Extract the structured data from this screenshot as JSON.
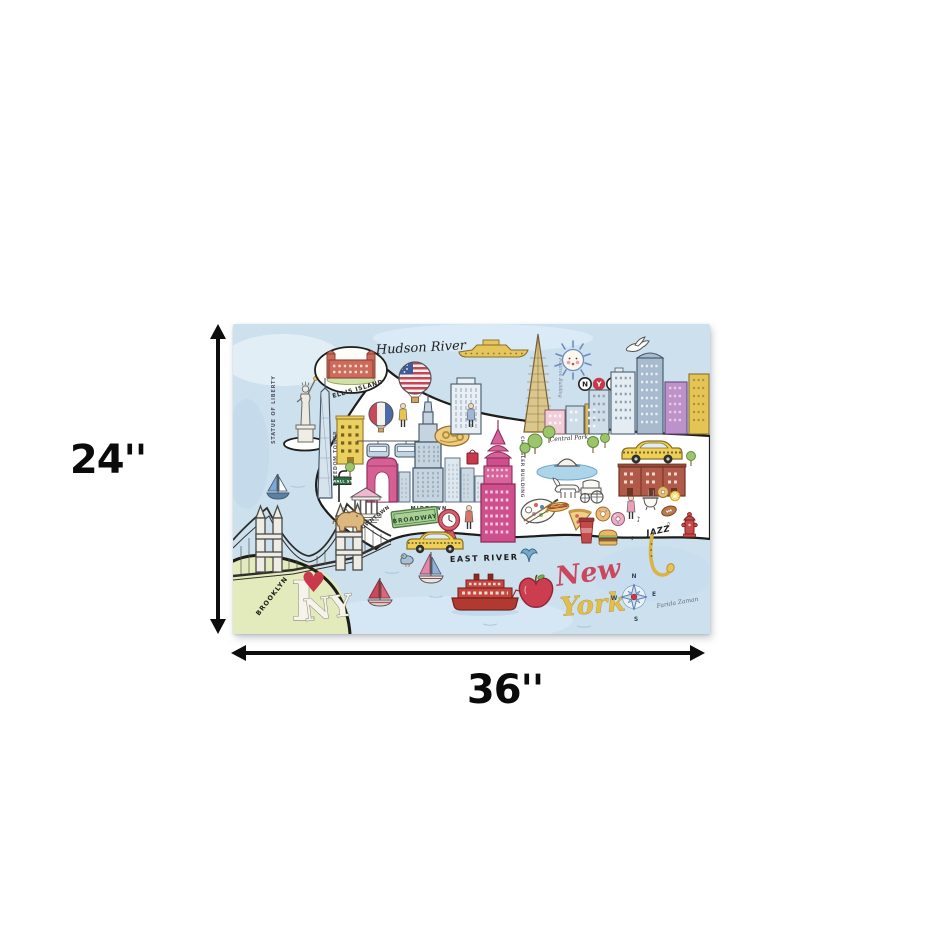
{
  "dimension_annotations": {
    "height_label": "24''",
    "width_label": "36''"
  },
  "artwork": {
    "rivers": {
      "hudson": "Hudson River",
      "east": "EAST RIVER"
    },
    "title": {
      "word1": "New",
      "word2": "York"
    },
    "landmark_labels": {
      "statue_of_liberty": "STATUE OF LIBERTY",
      "ellis_island": "ELLIS ISLAND",
      "freedom_tower": "FREEDOM TOWER",
      "wall_st": "WALL ST",
      "downtown": "DOWNTOWN",
      "midtown": "MIDTOWN",
      "broadway": "BROADWAY",
      "chrysler_building": "CHRYSLER BUILDING",
      "flatiron_building": "Flatiron Building",
      "central_park": "Central Park",
      "brooklyn": "BROOKLYN",
      "jazz": "JAZZ"
    },
    "nyc_badge": {
      "n": "N",
      "y": "Y",
      "c": "C"
    },
    "i_love_ny": {
      "i": "I",
      "heart": "♥",
      "ny": "NY"
    },
    "music_notes": {
      "note1": "♪",
      "note2": "♫",
      "note3": "♪"
    },
    "compass": {
      "north": "N",
      "east": "E",
      "south": "S",
      "west": "W"
    },
    "signature": "Farida Zaman",
    "palette": {
      "sky_blue": "#cde0ee",
      "island_white": "#ffffff",
      "brooklyn_green": "#e3ebbd",
      "pink": "#cf4f8e",
      "red": "#c8394b",
      "taxi_yellow": "#f0d052",
      "ink": "#1d1d1b"
    }
  }
}
